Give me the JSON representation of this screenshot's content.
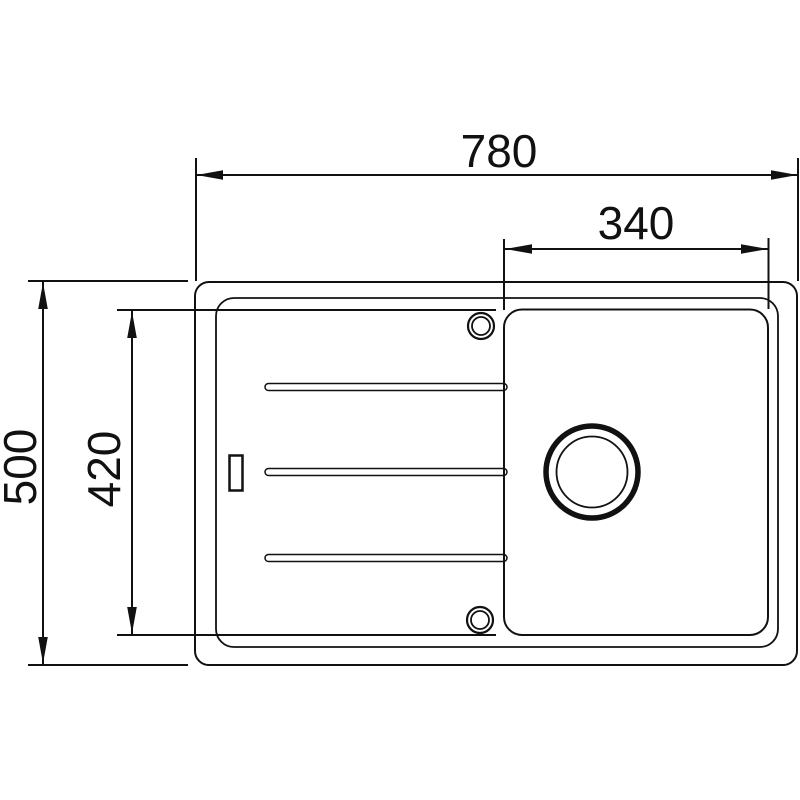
{
  "diagram": {
    "type": "technical-drawing",
    "subject": "kitchen sink with drainboard, top view",
    "background_color": "#ffffff",
    "line_color": "#111111",
    "dimensions": {
      "overall_width": {
        "label": "780",
        "orientation": "horizontal"
      },
      "bowl_width": {
        "label": "340",
        "orientation": "horizontal"
      },
      "overall_depth": {
        "label": "500",
        "orientation": "vertical"
      },
      "bowl_inner_depth": {
        "label": "420",
        "orientation": "vertical"
      }
    },
    "feature_counts": {
      "drainboard_grooves": 3,
      "tap_holes": 2,
      "overflow_slots": 1,
      "drain_openings": 1
    }
  }
}
